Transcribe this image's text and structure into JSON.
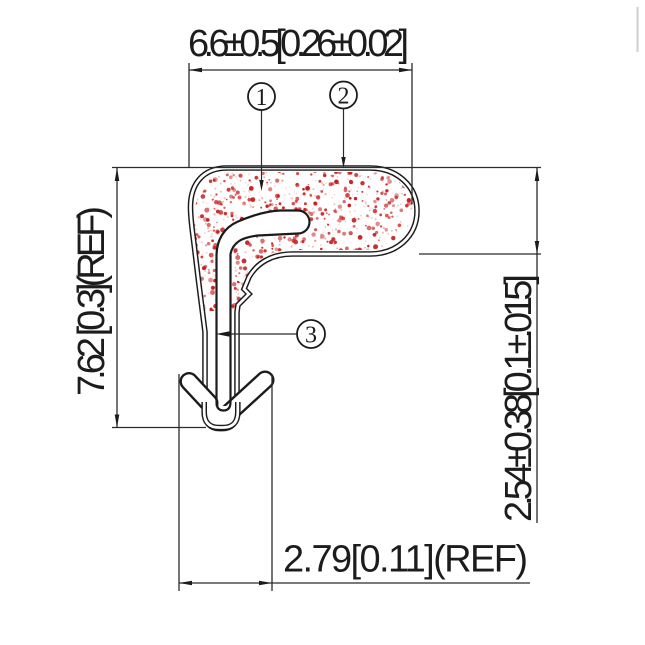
{
  "drawing": {
    "type": "technical-cross-section",
    "dimensions": {
      "top": "6.6±0.5[0.26±0.02]",
      "left": "7.62 [0.3](REF)",
      "right": "2.54±0.38[0.1±.015]",
      "bottom": "2.79[0.11](REF)"
    },
    "callouts": {
      "one": "1",
      "two": "2",
      "three": "3"
    },
    "colors": {
      "background": "#ffffff",
      "profile_line": "#1b1b1b",
      "dimension_line": "#2b2b2b",
      "speckle": "#c81e1e",
      "speckle_light": "#e09090",
      "edge_artifact": "#cfcfcf"
    },
    "speckles": {
      "seed": 9,
      "count": 700,
      "micro_count": 560
    }
  }
}
